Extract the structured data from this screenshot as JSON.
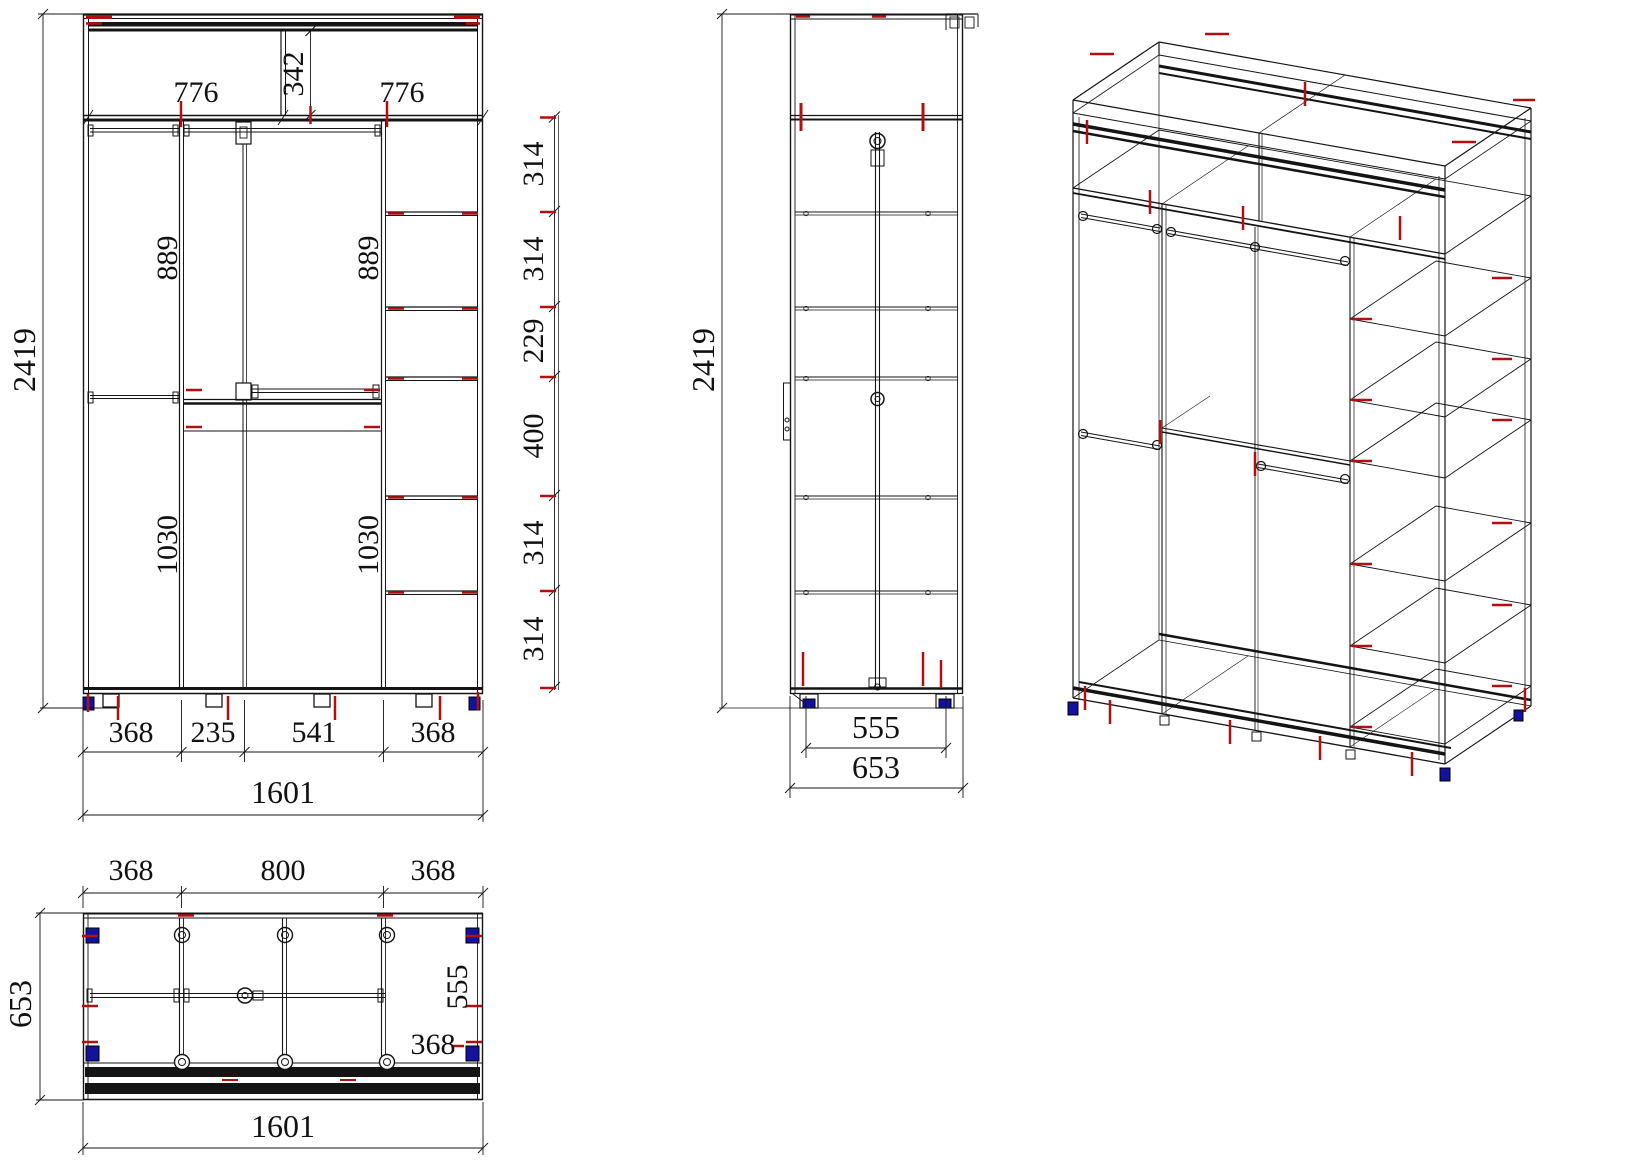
{
  "colors": {
    "line": "#141414",
    "marker_red": "#b01010",
    "foot_blue": "#12129e",
    "text": "#111111",
    "background": "#ffffff"
  },
  "front_view": {
    "height_total": "2419",
    "width_total": "1601",
    "top_height": "342",
    "top_widths": [
      "776",
      "776"
    ],
    "hang_upper": [
      "889",
      "889"
    ],
    "hang_lower": [
      "1030",
      "1030"
    ],
    "shelf_heights": [
      "314",
      "314",
      "229",
      "400",
      "314",
      "314"
    ],
    "bottom_widths": [
      "368",
      "235",
      "541",
      "368"
    ]
  },
  "side_view": {
    "height_total": "2419",
    "inner_depth": "555",
    "depth_total": "653"
  },
  "plan_view": {
    "top_widths": [
      "368",
      "800",
      "368"
    ],
    "depth_total": "653",
    "inner_depth": "555",
    "right_width": "368",
    "width_total": "1601"
  }
}
